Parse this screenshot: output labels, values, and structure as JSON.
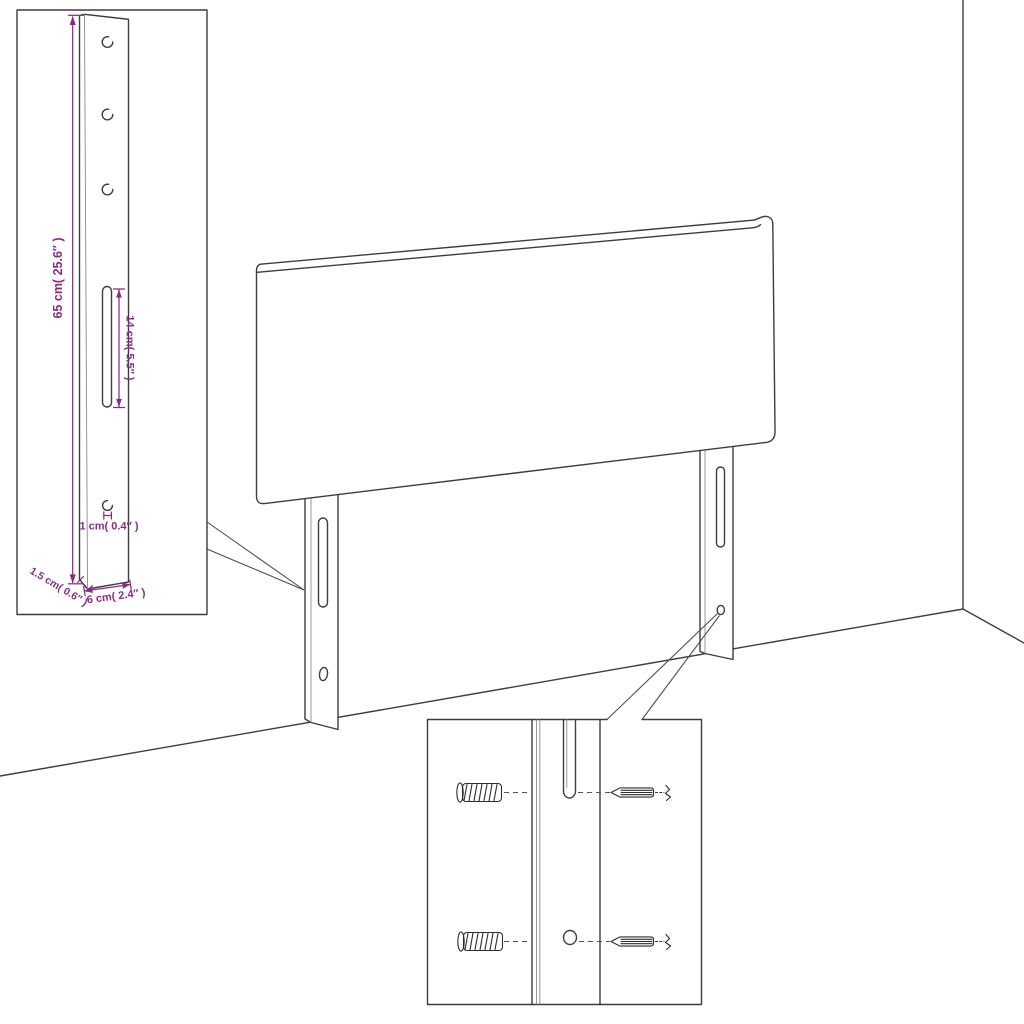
{
  "page": {
    "background_color": "#ffffff"
  },
  "diagram": {
    "description": "Line-art assembly dimension diagram of an upholstered headboard standing in a room corner, with two slotted mounting legs, a magnified leg-detail inset (left) carrying dimension annotations, and a magnified hardware-detail inset (bottom) showing wall anchors and screws aligned with the leg slot and hole",
    "colors": {
      "line_art": "#3d3d3d",
      "dimension_annotations": "#8b2b86",
      "background": "#ffffff"
    },
    "dims": {
      "leg_height": "65 cm( 25.6″ )",
      "slot_length": "14 cm( 5.5″ )",
      "hole_diameter": "1 cm( 0.4″ )",
      "leg_thickness": "1.5 cm( 0.6″ )",
      "leg_width": "6 cm( 2.4″ )"
    },
    "leg_detail_inset": {
      "screw_holes_count": 3,
      "slot_count": 1,
      "anchor_hole_count": 1
    },
    "hardware_detail_inset": {
      "wall_anchor_count": 2,
      "screw_count": 2,
      "rows": 2
    },
    "icons": {
      "wall_anchor": "hatched-cylinder-plug",
      "screw": "tapered-thread-screw",
      "break_symbol": "zigzag"
    }
  }
}
